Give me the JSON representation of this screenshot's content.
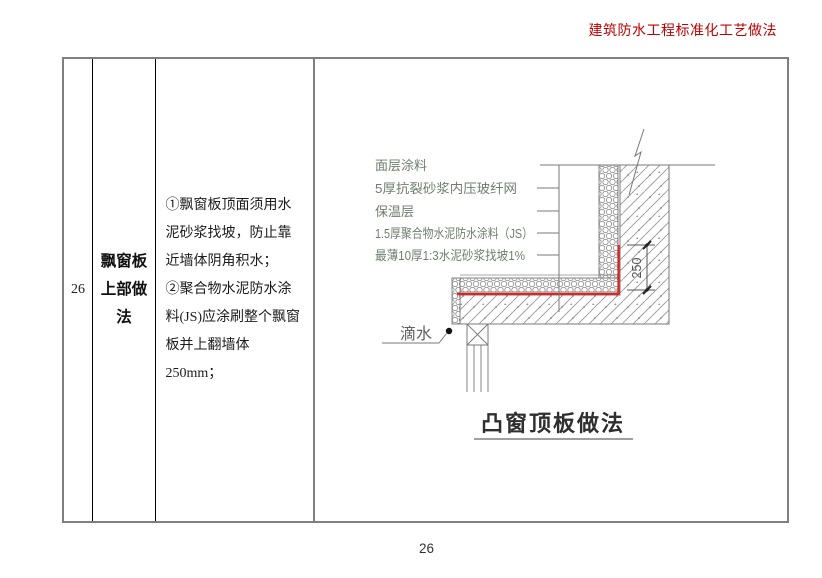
{
  "page": {
    "header_title": "建筑防水工程标准化工艺做法",
    "footer_page_number": "26"
  },
  "table": {
    "row_number": "26",
    "method_name": "飘窗板上部做法",
    "instructions": [
      "①飘窗板顶面须用水泥砂浆找坡，防止靠近墙体阴角积水；",
      "②聚合物水泥防水涂料(JS)应涂刷整个飘窗板并上翻墙体250mm；"
    ]
  },
  "diagram": {
    "layer_labels": [
      "面层涂料",
      "5厚抗裂砂浆内压玻纤网",
      "保温层",
      "1.5厚聚合物水泥防水涂料（JS）",
      "最薄10厚1:3水泥砂浆找坡1%"
    ],
    "drip_label": "滴水",
    "upturn_dimension": "250",
    "title": "凸窗顶板做法"
  },
  "colors": {
    "header_red": "#bf0000",
    "waterproof_red": "#e02424",
    "label_gray_green": "#6e7e6e",
    "linework_gray": "#7a7a7a"
  }
}
